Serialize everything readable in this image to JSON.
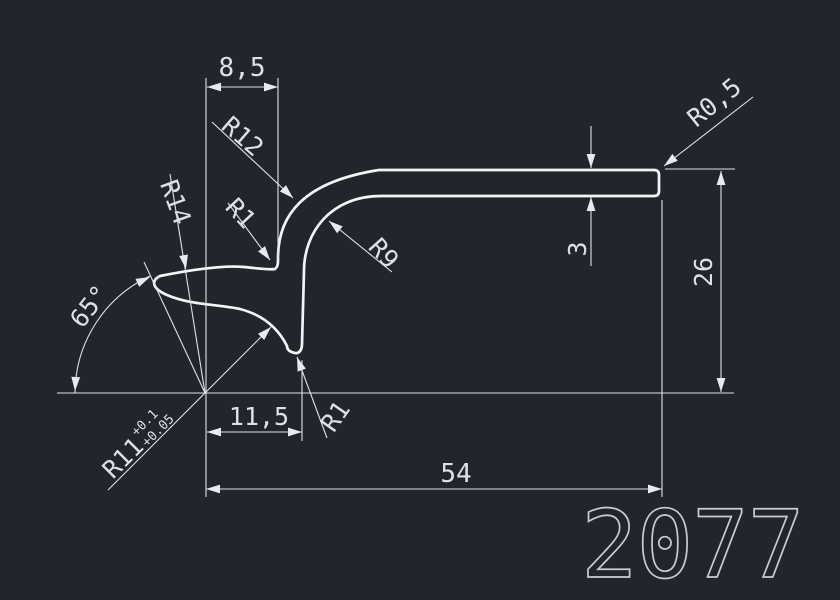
{
  "app": {
    "type": "cad-drawing-viewer",
    "view": "2d-profile-cross-section"
  },
  "colors": {
    "background": "#22262c",
    "geometry_line": "#f2f4f6",
    "dimension_line": "#dfe3e7",
    "dimension_text": "#dde1e5",
    "part_number_stroke": "#c7ccd1"
  },
  "labels": {
    "dim_top_width": "8,5",
    "r12": "R12",
    "r14": "R14",
    "r1_upper": "R1",
    "r9": "R9",
    "r0_5": "R0,5",
    "thickness": "3",
    "height": "26",
    "angle": "65°",
    "r11": "R11",
    "r11_tol_upper": "+0.1",
    "r11_tol_lower": "+0.05",
    "dim_lip_offset": "11,5",
    "r1_lower": "R1",
    "length": "54",
    "part_number": "2077"
  }
}
